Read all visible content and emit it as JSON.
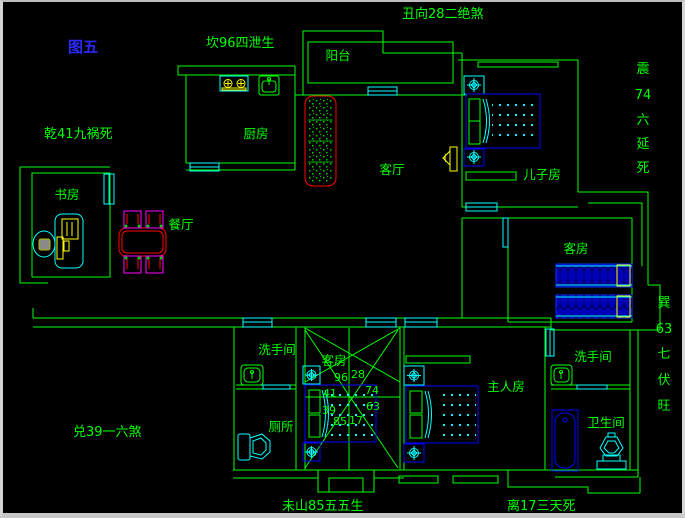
{
  "figure": {
    "label": "图五"
  },
  "fengshui": {
    "top": "丑向28二绝煞",
    "north": "坎96四泄生",
    "northwest": "乾41九祸死",
    "west": "兑39一六煞",
    "south_left": "未山85五五生",
    "south_right": "离17三天死",
    "east_vertical": [
      "震",
      "74",
      "六",
      "延",
      "死"
    ],
    "southeast_vertical": [
      "巽",
      "63",
      "七",
      "伏",
      "旺"
    ],
    "compass_numbers": [
      "96",
      "28",
      "41",
      "74",
      "39",
      "63",
      "85",
      "17"
    ]
  },
  "rooms": {
    "balcony": "阳台",
    "kitchen": "厨房",
    "living": "客厅",
    "son": "儿子房",
    "dining": "餐厅",
    "study": "书房",
    "guest_east": "客房",
    "guest_south": "客房",
    "washroom_west": "洗手间",
    "toilet": "厕所",
    "master": "主人房",
    "washroom_east": "洗手间",
    "bathroom": "卫生间"
  },
  "colors": {
    "background": "#000000",
    "wall": "#00ff00",
    "fixture": "#00ffff",
    "furniture": "#0000ff",
    "accent": "#ffff00",
    "sofa": "#ff0000",
    "chair": "#ff00ff",
    "figure_label": "#2a2aff"
  }
}
